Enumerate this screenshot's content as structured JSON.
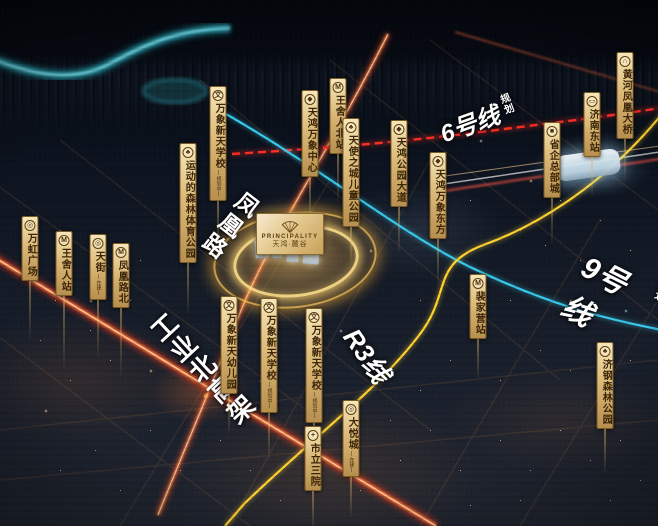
{
  "project_plaque": {
    "name_en": "PRINCIPALITY",
    "name_cn": "天鸿·麓谷",
    "icon": "fan-icon"
  },
  "road_labels": {
    "fenghuang_road": {
      "label": "凤凰路"
    },
    "gongye_north_viaduct": {
      "label": "工业北高架"
    },
    "line6": {
      "label": "6号线",
      "sub_label": "规划",
      "color": "#ff2e24"
    },
    "line9": {
      "label": "9号线",
      "sub_label": "规划",
      "color": "#38c9ea"
    },
    "r3_line": {
      "label": "R3线",
      "color": "#ffd230"
    }
  },
  "markers": [
    {
      "label": "万虹广场",
      "icon": "plaza-icon",
      "glyph": "◎",
      "x": 30,
      "y": 216,
      "stem": 58
    },
    {
      "label": "王舍人站",
      "icon": "metro-icon",
      "glyph": "M",
      "x": 64,
      "y": 231,
      "stem": 72
    },
    {
      "label": "天街",
      "sub": "(在建)",
      "icon": "mall-icon",
      "glyph": "◎",
      "x": 98,
      "y": 234,
      "stem": 58
    },
    {
      "label": "凤凰路北",
      "icon": "metro-icon",
      "glyph": "M",
      "x": 121,
      "y": 243,
      "stem": 68
    },
    {
      "label": "运动的森林体育公园",
      "icon": "park-icon",
      "glyph": "♣",
      "x": 188,
      "y": 143,
      "stem": 50
    },
    {
      "label": "万象新天学校",
      "sub": "(规划中)",
      "icon": "school-icon",
      "glyph": "文",
      "x": 218,
      "y": 86,
      "stem": 48
    },
    {
      "label": "天鸿万象中心",
      "icon": "landmark-icon",
      "glyph": "◆",
      "x": 310,
      "y": 90,
      "stem": 50
    },
    {
      "label": "王舍人北站",
      "icon": "metro-icon",
      "glyph": "M",
      "x": 338,
      "y": 78,
      "stem": 48
    },
    {
      "label": "天使之城儿童公园",
      "icon": "park-icon",
      "glyph": "♣",
      "x": 351,
      "y": 118,
      "stem": 36
    },
    {
      "label": "天鸿公园大道",
      "icon": "landmark-icon",
      "glyph": "◆",
      "x": 399,
      "y": 120,
      "stem": 46
    },
    {
      "label": "天鸿万象东方",
      "icon": "landmark-icon",
      "glyph": "◆",
      "x": 438,
      "y": 152,
      "stem": 46
    },
    {
      "label": "黄河凤凰大桥",
      "icon": "bridge-icon",
      "glyph": "∩",
      "x": 625,
      "y": 52,
      "stem": 40
    },
    {
      "label": "济南东站",
      "icon": "train-icon",
      "glyph": "▭",
      "x": 592,
      "y": 92,
      "stem": 40
    },
    {
      "label": "省企总部城",
      "icon": "hq-icon",
      "glyph": "■",
      "x": 552,
      "y": 122,
      "stem": 46
    },
    {
      "label": "裴家营站",
      "icon": "metro-icon",
      "glyph": "M",
      "x": 478,
      "y": 274,
      "stem": 40
    },
    {
      "label": "济钢森林公园",
      "icon": "park-icon",
      "glyph": "♣",
      "x": 605,
      "y": 342,
      "stem": 44
    },
    {
      "label": "万象新天幼儿园",
      "icon": "school-icon",
      "glyph": "文",
      "x": 229,
      "y": 296,
      "stem": 40
    },
    {
      "label": "万象新天学校",
      "sub": "(规划中)",
      "icon": "school-icon",
      "glyph": "文",
      "x": 269,
      "y": 298,
      "stem": 46
    },
    {
      "label": "万象新天学校",
      "sub": "(规划中)",
      "icon": "school-icon",
      "glyph": "文",
      "x": 314,
      "y": 308,
      "stem": 50
    },
    {
      "label": "大悦城",
      "sub": "(在建)",
      "icon": "mall-icon",
      "glyph": "◎",
      "x": 351,
      "y": 400,
      "stem": 40
    },
    {
      "label": "市立三院",
      "icon": "hospital-icon",
      "glyph": "+",
      "x": 313,
      "y": 426,
      "stem": 40
    }
  ],
  "colors": {
    "tag_gold": "#dcba79",
    "tag_text": "#3b2508",
    "ring_gold": "#ffcf6e",
    "river_teal": "#2fb3c4",
    "road_trail": "#ff7a3c",
    "line6_red": "#ff2e24",
    "line9_cyan": "#38c9ea",
    "r3_yellow": "#ffd230"
  }
}
